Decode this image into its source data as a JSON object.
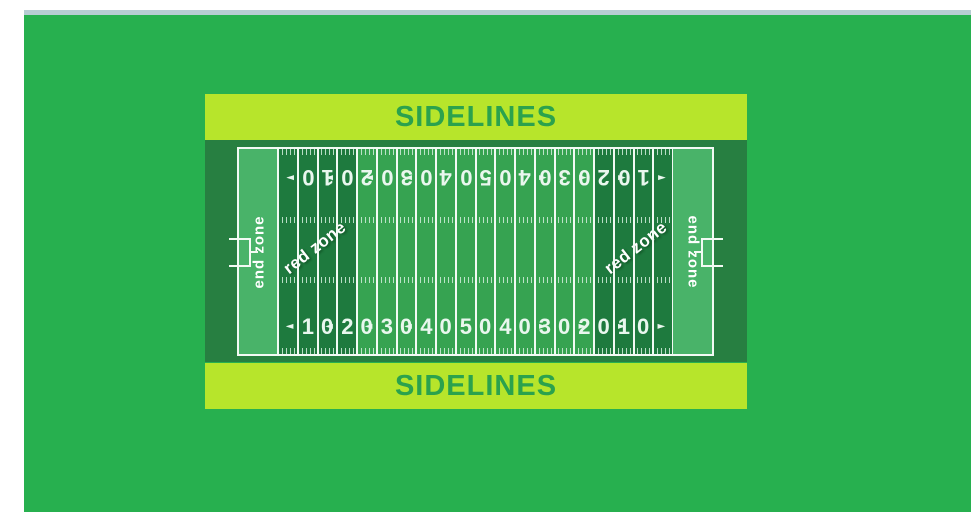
{
  "window": {
    "background_color": "#ffffff",
    "top_strip_color": "#b7cdd3",
    "canvas_color": "#27b04f"
  },
  "sidelines": {
    "top_label": "SIDELINES",
    "bottom_label": "SIDELINES",
    "bar_color": "#b7e52b",
    "text_color": "#2ba24d"
  },
  "field": {
    "end_zone_left_label": "end zone",
    "end_zone_right_label": "end zone",
    "red_zone_left_label": "red zone",
    "red_zone_right_label": "red zone",
    "yard_numbers_top": [
      "10",
      "20",
      "30",
      "40",
      "50",
      "40",
      "30",
      "20",
      "10"
    ],
    "yard_numbers_bottom": [
      "10",
      "20",
      "30",
      "40",
      "50",
      "40",
      "30",
      "20",
      "10"
    ],
    "arrow_left_glyph": "◄",
    "arrow_right_glyph": "►",
    "colors": {
      "frame": "#277f41",
      "end_zone": "#49b369",
      "red_zone": "#1e7a3e",
      "midfield": "#36a351",
      "line": "#f2faf4",
      "hash": "#d4eedd",
      "number": "#e9f7ee"
    }
  }
}
